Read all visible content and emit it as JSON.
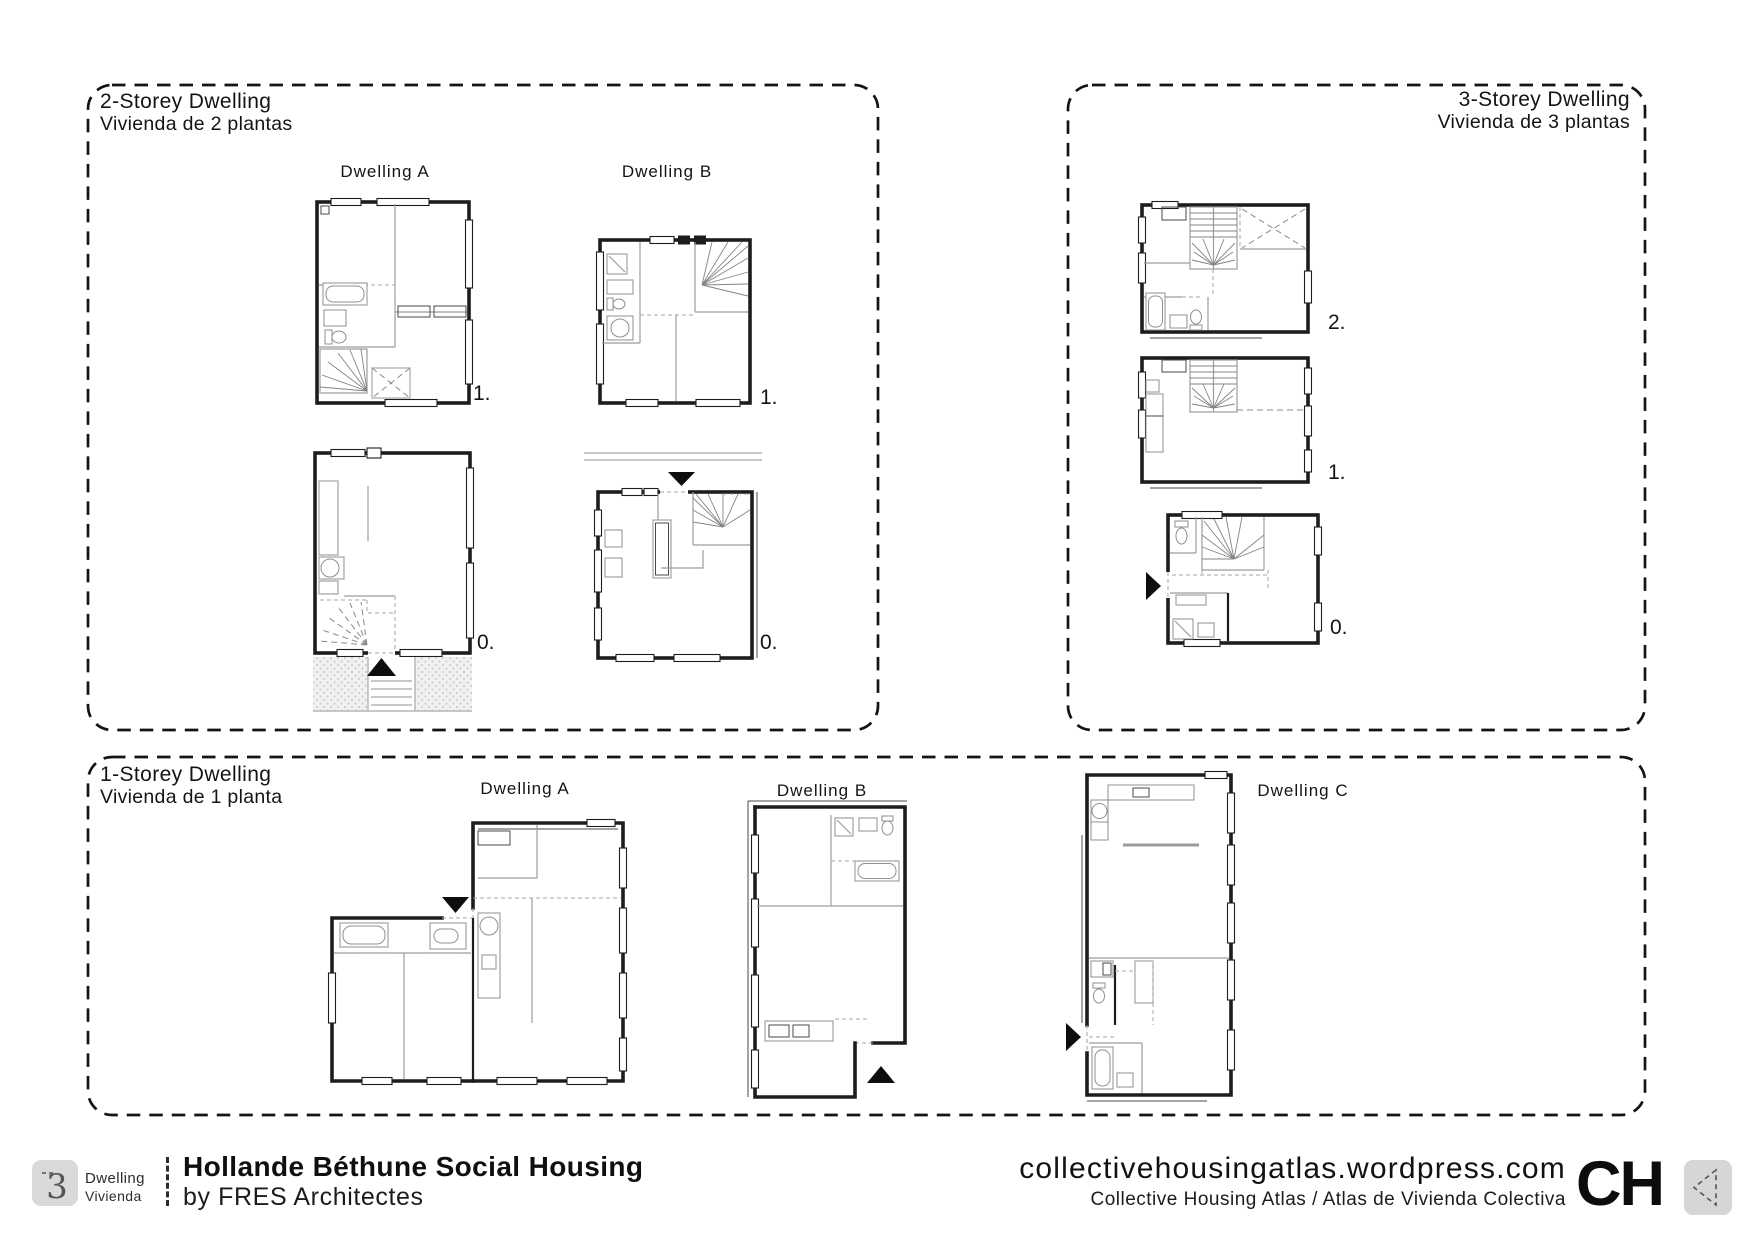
{
  "panels": {
    "two_storey": {
      "title": "2-Storey Dwelling",
      "subtitle": "Vivienda de 2 plantas",
      "dwellings": [
        {
          "label": "Dwelling A"
        },
        {
          "label": "Dwelling B"
        }
      ],
      "level_labels": {
        "a_upper": "1.",
        "a_ground": "0.",
        "b_upper": "1.",
        "b_ground": "0."
      }
    },
    "three_storey": {
      "title": "3-Storey Dwelling",
      "subtitle": "Vivienda de 3 plantas",
      "level_labels": {
        "second": "2.",
        "first": "1.",
        "ground": "0."
      }
    },
    "one_storey": {
      "title": "1-Storey Dwelling",
      "subtitle": "Vivienda de 1 planta",
      "dwellings": [
        {
          "label": "Dwelling A"
        },
        {
          "label": "Dwelling B"
        },
        {
          "label": "Dwelling C"
        }
      ]
    }
  },
  "footer": {
    "badge": {
      "number": "3",
      "label_en": "Dwelling",
      "label_es": "Vivienda"
    },
    "project": {
      "title": "Hollande Béthune Social Housing",
      "byline": "by FRES Architectes"
    },
    "site": {
      "url": "collectivehousingatlas.wordpress.com",
      "name": "Collective Housing Atlas / Atlas de Vivienda Colectiva",
      "logo": "CH"
    }
  },
  "colors": {
    "wall": "#1d1d1d",
    "partition": "#9c9c9c",
    "panel_border": "#141414",
    "badge_bg": "#d9d9d9",
    "logo_box_bg": "#d6d6d6"
  }
}
